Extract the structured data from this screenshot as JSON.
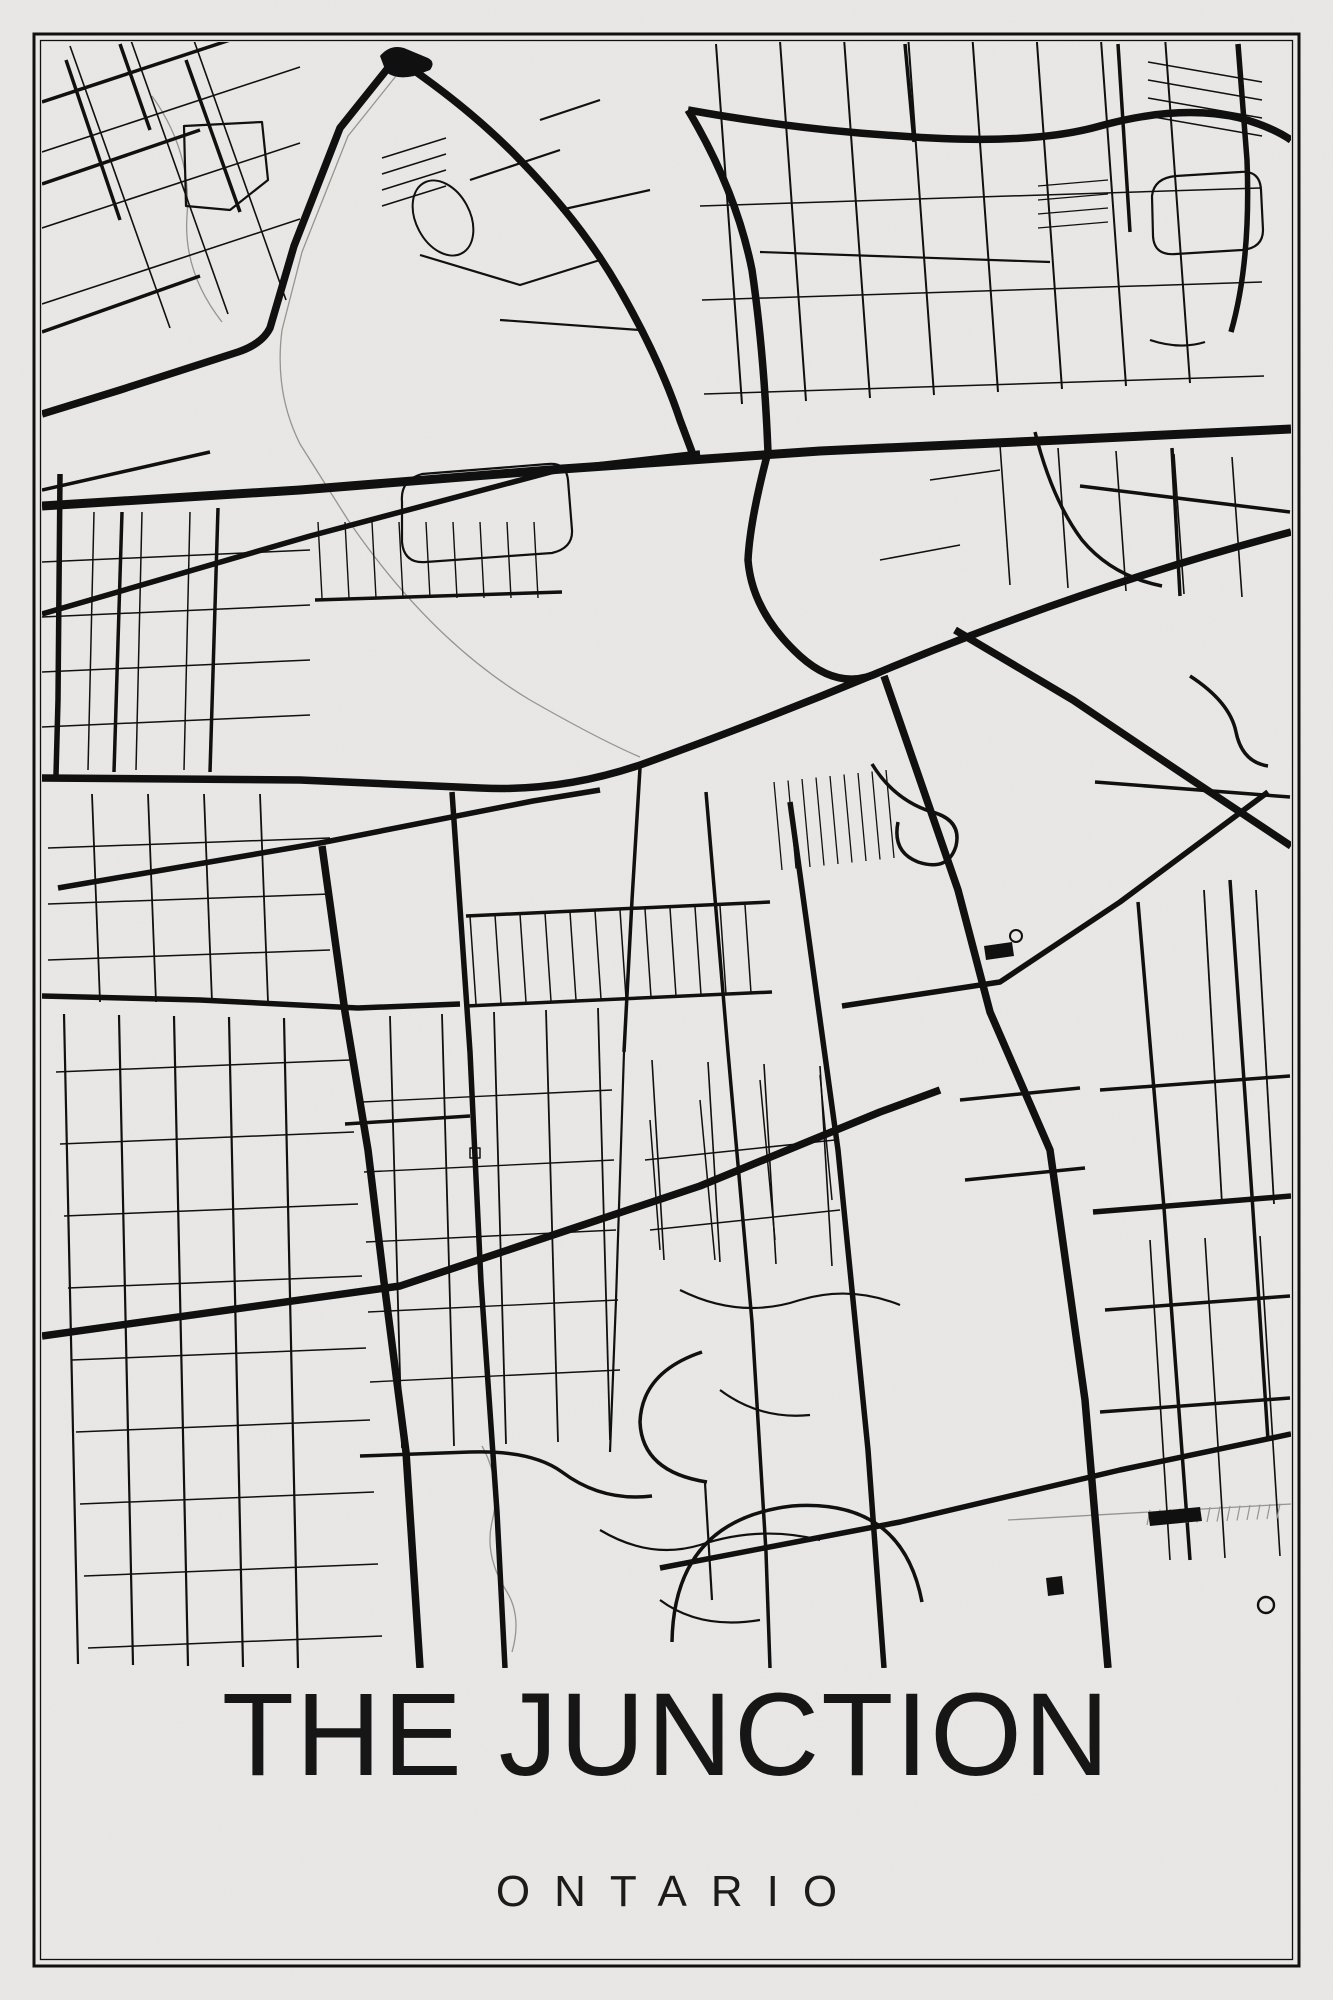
{
  "poster": {
    "title": "THE JUNCTION",
    "subtitle": "ONTARIO"
  },
  "colors": {
    "paper": "#e9e8e6",
    "ink": "#101010",
    "faint": "#979590",
    "title": "#161616"
  },
  "frame": {
    "outer_inset": 34,
    "outer_width": 3,
    "inner_inset": 40.5,
    "inner_width": 1.3
  },
  "map": {
    "width": 1333,
    "height": 2000,
    "clip": [
      42,
      42,
      1249,
      1626
    ],
    "layers": [
      {
        "name": "highway",
        "width": 9,
        "paths": [
          "M42,506 L300,490 L562,469 L820,451 L1060,440 L1291,429"
        ]
      },
      {
        "name": "major",
        "width": 7.5,
        "paths": [
          "M396,58 L340,128 L294,246 L270,328 Q262,344 238,352 L120,390 L42,414",
          "M396,58 Q470,108 520,160 Q583,225 620,290 Q660,360 680,420 L692,452",
          "M688,110 Q800,130 900,136 Q1030,146 1100,126 Q1180,104 1240,118 Q1272,127 1291,140",
          "M688,110 Q736,190 752,270 Q764,352 768,452",
          "M42,778 L300,780 L480,788 Q560,792 640,765 Q760,722 880,672 Q1080,588 1291,532",
          "M768,452 Q750,520 748,560 Q752,612 800,656 Q840,692 880,672",
          "M955,630 L1073,700 L1180,772 L1291,846",
          "M884,676 L920,780 L958,890 L990,1012 L1050,1150 L1085,1400 L1108,1668",
          "M322,846 L345,1012 L368,1150 L384,1282 L406,1452 L420,1668",
          "M42,1336 L400,1286 L700,1186 L880,1112 L940,1090"
        ]
      },
      {
        "name": "semi",
        "width": 5.5,
        "paths": [
          "M42,614 L310,536 L562,469 L700,453",
          "M58,888 L320,843 L533,801 L600,790",
          "M452,792 L470,1052 L481,1282 L497,1512 L505,1668",
          "M790,802 L838,1150 L868,1450 L884,1668",
          "M1093,1212 L1291,1196",
          "M842,1006 L1000,982 L1120,902 L1268,792",
          "M60,474 L58,700 L56,775",
          "M1238,44 L1247,160 Q1251,262 1231,332",
          "M42,996 L200,1000 L358,1008 L460,1004",
          "M660,1568 L900,1522 L1120,1470 L1291,1434"
        ]
      },
      {
        "name": "medium",
        "width": 3.5,
        "paths": [
          "M42,102 L230,40",
          "M42,184 L200,130",
          "M42,332 L200,276",
          "M42,490 L210,452",
          "M66,60 L120,220",
          "M186,60 L240,212",
          "M120,44 L150,130",
          "M122,512 L114,772",
          "M218,508 L210,772",
          "M466,916 L770,902",
          "M466,1006 L772,992",
          "M345,1124 L470,1116",
          "M640,768 L632,900 L624,1052",
          "M706,792 L728,1052 L752,1322 L766,1552 L770,1668",
          "M905,44 L914,142",
          "M1118,44 L1130,232",
          "M1035,432 Q1052,500 1082,540 Q1112,576 1162,586",
          "M1172,448 L1180,596",
          "M1080,486 L1290,512",
          "M1190,676 Q1230,702 1236,732 Q1242,762 1268,766",
          "M1095,782 L1290,797",
          "M1100,1090 L1290,1076",
          "M1105,1310 L1290,1296",
          "M1100,1412 L1290,1398",
          "M1138,902 L1164,1208 L1182,1452 L1190,1560",
          "M1230,880 L1252,1196 L1268,1440",
          "M960,1100 L1080,1088",
          "M965,1180 L1085,1168",
          "M872,764 Q894,800 932,812 Q962,820 956,846 Q948,872 918,862 Q892,852 898,822",
          "M672,1642 Q674,1520 792,1506 Q902,1498 922,1602",
          "M360,1456 L470,1452 Q532,1450 562,1472 Q602,1502 652,1496",
          "M702,1352 Q642,1372 640,1422 Q642,1472 707,1482",
          "M315,600 L562,592"
        ]
      },
      {
        "name": "collector",
        "width": 2.2,
        "paths": [
          "M402,502 Q400,480 422,474 L548,464 Q566,462 568,480 L572,530 Q573,548 552,553 L426,562 Q404,564 402,542 Z",
          "M184,126 L262,122 L268,180 L230,210 L186,206 Z",
          "M1152,196 Q1154,178 1176,176 L1240,172 Q1260,170 1261,190 L1263,230 Q1263,248 1242,250 L1176,254 Q1154,256 1153,236 Z",
          "M624,1052 L616,1300 L610,1452",
          "M470,180 L560,150",
          "M420,255 L520,285 L600,260",
          "M500,320 L640,330",
          "M540,120 L600,100",
          "M560,210 L650,190",
          "M680,1290 Q740,1320 800,1300 Q850,1285 900,1305",
          "M720,1390 Q760,1420 810,1415",
          "M600,1530 Q650,1560 700,1545 Q760,1525 820,1540",
          "M660,1600 Q700,1630 760,1620",
          "M705,1483 L712,1600",
          "M1150,340 Q1180,350 1205,342",
          "M760,252 L1050,262"
        ]
      },
      {
        "name": "minor",
        "width": 1.5,
        "paths": [
          "M645,1160 L835,1140",
          "M650,1230 L840,1210",
          "M650,1120 L660,1250",
          "M700,1100 L715,1260",
          "M760,1080 L775,1240",
          "M820,1075 L832,1200",
          "M470,1148 L480,1148 L480,1158 L470,1158 Z",
          "M880,560 L960,545",
          "M930,480 L1000,470"
        ]
      }
    ],
    "faint": {
      "width": 1.3,
      "paths": [
        "M404,66 L348,136 L302,252 L282,330 Q274,392 300,444 L348,520 Q430,640 530,700 Q600,740 640,757",
        "M152,96 Q192,152 187,216 Q183,272 222,322",
        "M482,1446 Q502,1482 492,1522 Q484,1556 507,1592 Q522,1617 512,1652",
        "M1008,1520 L1291,1504"
      ]
    },
    "grids": [
      {
        "x": 70,
        "y": 46,
        "ex": 100,
        "ey": 282,
        "n": 3,
        "sx": 58,
        "sy": -14,
        "w": 1.6
      },
      {
        "x": 42,
        "y": 152,
        "ex": 258,
        "ey": -85,
        "n": 3,
        "sx": 0,
        "sy": 76,
        "w": 1.6
      },
      {
        "x": 382,
        "y": 158,
        "ex": 64,
        "ey": -20,
        "n": 4,
        "sx": 0,
        "sy": 16,
        "w": 1.5
      },
      {
        "x": 716,
        "y": 44,
        "ex": 26,
        "ey": 360,
        "n": 8,
        "sx": 64,
        "sy": -3,
        "w": 2
      },
      {
        "x": 700,
        "y": 206,
        "ex": 560,
        "ey": -18,
        "n": 3,
        "sx": 2,
        "sy": 94,
        "w": 1.5
      },
      {
        "x": 94,
        "y": 512,
        "ex": -6,
        "ey": 258,
        "n": 3,
        "sx": 48,
        "sy": 0,
        "w": 1.5
      },
      {
        "x": 42,
        "y": 562,
        "ex": 268,
        "ey": -12,
        "n": 4,
        "sx": 0,
        "sy": 55,
        "w": 1.5
      },
      {
        "x": 470,
        "y": 916,
        "ex": 6,
        "ey": 88,
        "n": 12,
        "sx": 25,
        "sy": -1,
        "w": 1.5
      },
      {
        "x": 774,
        "y": 782,
        "ex": 8,
        "ey": 88,
        "n": 9,
        "sx": 14,
        "sy": -1.5,
        "w": 1.3
      },
      {
        "x": 64,
        "y": 1014,
        "ex": 14,
        "ey": 650,
        "n": 5,
        "sx": 55,
        "sy": 1,
        "w": 2.2
      },
      {
        "x": 56,
        "y": 1072,
        "ex": 294,
        "ey": -12,
        "n": 9,
        "sx": 4,
        "sy": 72,
        "w": 1.5
      },
      {
        "x": 48,
        "y": 848,
        "ex": 282,
        "ey": -10,
        "n": 3,
        "sx": 0,
        "sy": 56,
        "w": 1.5
      },
      {
        "x": 92,
        "y": 794,
        "ex": 8,
        "ey": 208,
        "n": 4,
        "sx": 56,
        "sy": 0,
        "w": 1.8
      },
      {
        "x": 390,
        "y": 1016,
        "ex": 12,
        "ey": 432,
        "n": 5,
        "sx": 52,
        "sy": -2,
        "w": 1.8
      },
      {
        "x": 362,
        "y": 1102,
        "ex": 250,
        "ey": -12,
        "n": 5,
        "sx": 2,
        "sy": 70,
        "w": 1.4
      },
      {
        "x": 652,
        "y": 1060,
        "ex": 12,
        "ey": 200,
        "n": 4,
        "sx": 56,
        "sy": 2,
        "w": 1.6
      },
      {
        "x": 1204,
        "y": 890,
        "ex": 18,
        "ey": 314,
        "n": 2,
        "sx": 52,
        "sy": 0,
        "w": 1.8
      },
      {
        "x": 1150,
        "y": 1240,
        "ex": 20,
        "ey": 320,
        "n": 3,
        "sx": 55,
        "sy": -2,
        "w": 1.6
      },
      {
        "x": 318,
        "y": 522,
        "ex": 4,
        "ey": 76,
        "n": 9,
        "sx": 27,
        "sy": 0,
        "w": 1.4
      },
      {
        "x": 1000,
        "y": 445,
        "ex": 10,
        "ey": 140,
        "n": 5,
        "sx": 58,
        "sy": 3,
        "w": 1.6
      },
      {
        "x": 1148,
        "y": 62,
        "ex": 114,
        "ey": 20,
        "n": 4,
        "sx": 0,
        "sy": 18,
        "w": 1.5
      },
      {
        "x": 1038,
        "y": 186,
        "ex": 70,
        "ey": -6,
        "n": 4,
        "sx": 0,
        "sy": 14,
        "w": 1.3
      },
      {
        "x": 1150,
        "y": 1510,
        "ex": -3,
        "ey": 15,
        "n": 14,
        "sx": 10,
        "sy": -0.5,
        "w": 1.2,
        "f": true
      }
    ],
    "shapes": {
      "blob": "M380,56 Q390,44 404,48 L428,58 Q436,62 430,70 L414,76 Q396,80 386,72 Z",
      "station": "M1148,1512 L1200,1507 L1202,1521 L1150,1526 Z",
      "small_block": "M1046,1578 L1062,1576 L1064,1594 L1048,1596 Z",
      "mini_depot": "M984,946 L1012,942 L1014,956 L986,960 Z",
      "circle": {
        "cx": 1266,
        "cy": 1605,
        "r": 8,
        "w": 2.4
      },
      "loop": {
        "cx": 1016,
        "cy": 936,
        "r": 6,
        "w": 2
      },
      "oval": {
        "cx": 443,
        "cy": 218,
        "rx": 27,
        "ry": 40,
        "rot": -28,
        "w": 2
      }
    }
  }
}
